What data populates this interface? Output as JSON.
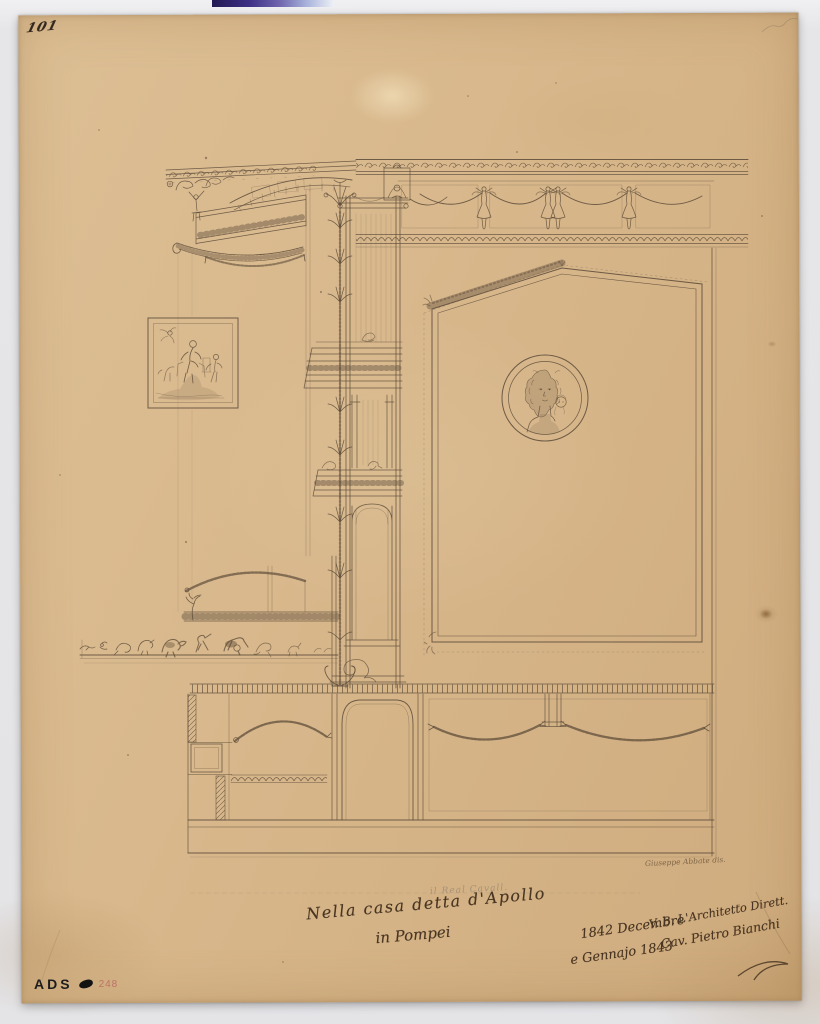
{
  "scan": {
    "page_number": "101",
    "stamp": {
      "label": "ADS",
      "number": "248"
    },
    "inscriptions": {
      "pencil_note": "il Real Cavall.",
      "title_line1": "Nella casa detta d'Apollo",
      "title_line2": "in Pompei",
      "date_line1": "1842 Decembre",
      "date_line2": "e Gennajo 1843",
      "approval_line1": "V. B. L'Architetto Dirett.",
      "approval_line2": "Cav. Pietro Bianchi",
      "artist_signature": "Giuseppe Abbate dis."
    },
    "colors": {
      "paper": "#d8b88c",
      "ink": "#5a4a38",
      "background": "#e6e6e8"
    }
  }
}
